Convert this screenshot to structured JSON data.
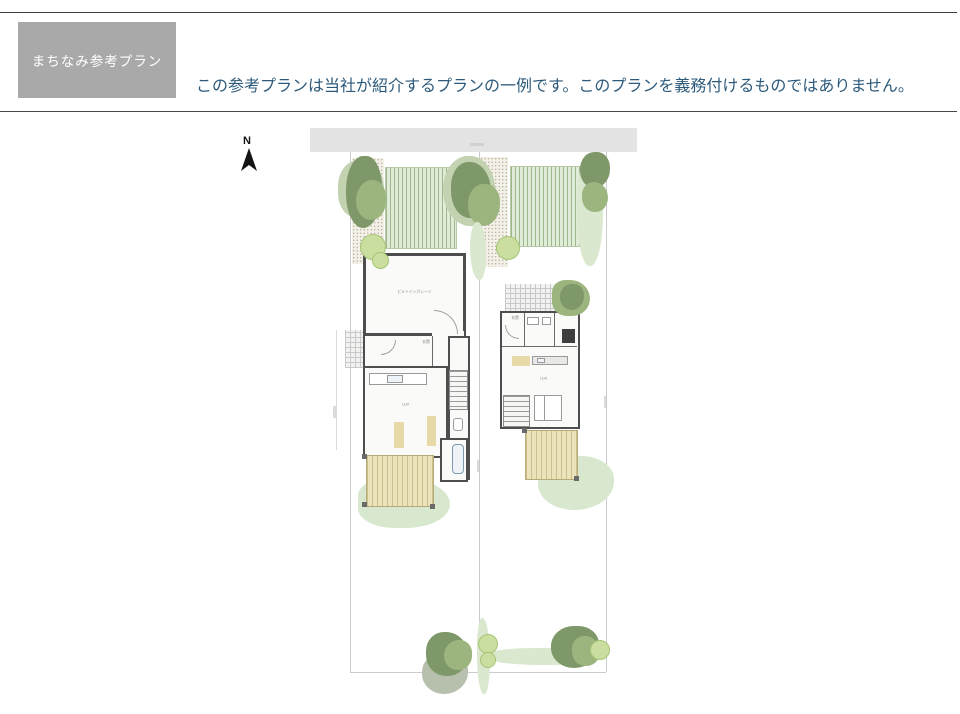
{
  "header": {
    "tag_label": "まちなみ参考プラン",
    "disclaimer": "この参考プランは当社が紹介するプランの一例です。このプランを義務付けるものではありません。"
  },
  "compass": {
    "north_label": "N"
  },
  "plan": {
    "left_house": {
      "garage_label": "ビルトインガレージ",
      "entrance_label": "玄関",
      "living_label": "LDK"
    },
    "right_house": {
      "entrance_label": "玄関",
      "living_label": "LDK"
    }
  },
  "colors": {
    "tag_bg": "#a9a9a9",
    "disclaimer_text": "#2d5a7b",
    "road": "#e3e3e3",
    "lawn": "#e1ecd8",
    "lawn_stripe": "#9cb88c",
    "deck": "#ece3ba",
    "tree_dark": "#7f986a",
    "tree_mid": "#9cb57e",
    "tree_light": "#c3d2b0",
    "wall": "#4e4e4e",
    "ground_cover": "#d8e8ce"
  }
}
